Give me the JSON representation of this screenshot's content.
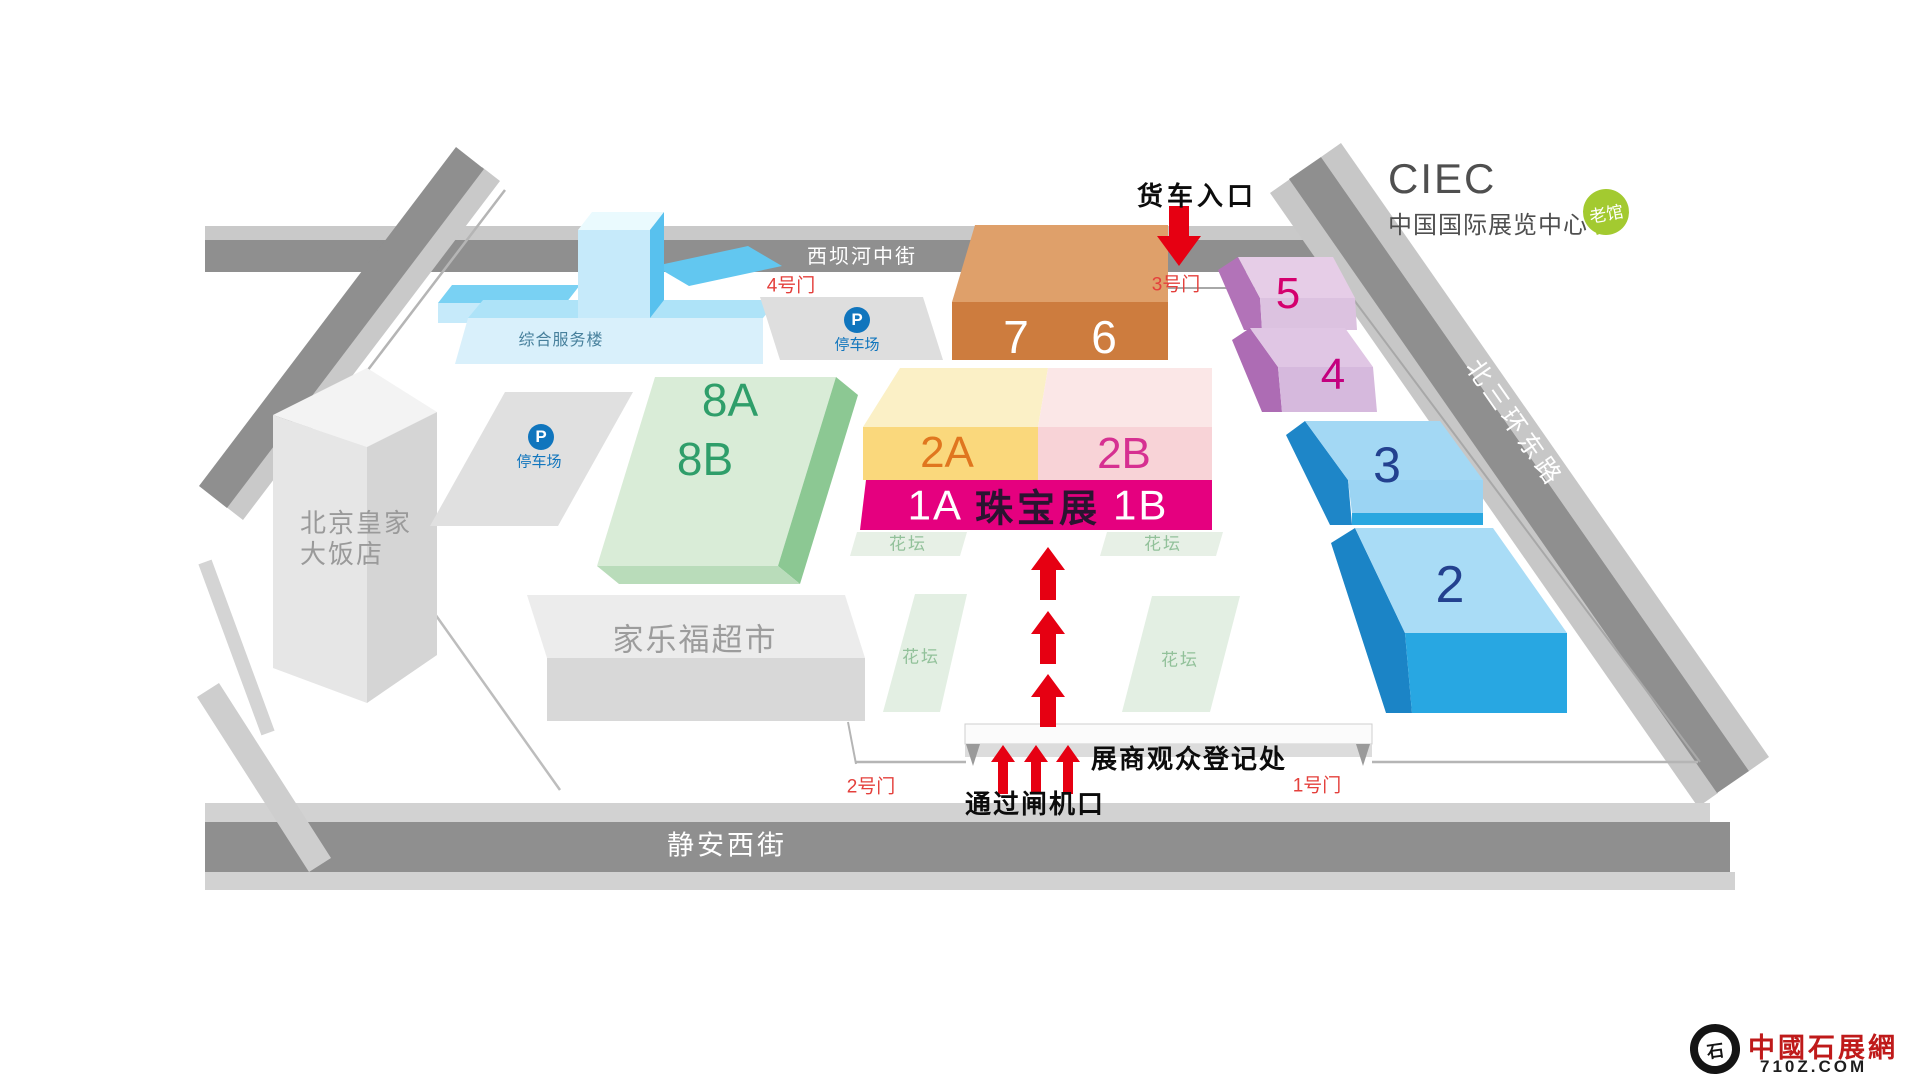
{
  "brand": {
    "acronym": "CIEC",
    "name": "中国国际展览中心",
    "badge": "老馆"
  },
  "streets": {
    "north": "西坝河中街",
    "west": "七圣南路",
    "east": "北三环东路",
    "south": "静安西街"
  },
  "buildings": {
    "hotel_line1": "北京皇家",
    "hotel_line2": "大饭店",
    "service": "综合服务楼",
    "supermarket": "家乐福超市"
  },
  "parking": {
    "icon": "P",
    "label": "停车场"
  },
  "halls": {
    "h8a": "8A",
    "h8b": "8B",
    "h7": "7",
    "h6": "6",
    "h5": "5",
    "h4": "4",
    "h3": "3",
    "h2": "2",
    "h2a": "2A",
    "h2b": "2B"
  },
  "banner": {
    "left": "1A",
    "title": "珠宝展",
    "right": "1B"
  },
  "gates": {
    "g1": "1号门",
    "g2": "2号门",
    "g3": "3号门",
    "g4": "4号门"
  },
  "notes": {
    "truck": "货车入口",
    "registration": "展商观众登记处",
    "turnstile": "通过闸机口",
    "flowerbed": "花坛"
  },
  "watermark": {
    "name": "中國石展網",
    "url": "710Z.COM",
    "seal": "石"
  },
  "colors": {
    "banner_pink": "#e5007f",
    "arrow_red": "#e60012",
    "gate_red": "#e4403c",
    "badge_green": "#a3ca30",
    "road_gray": "#8f8f8f"
  }
}
